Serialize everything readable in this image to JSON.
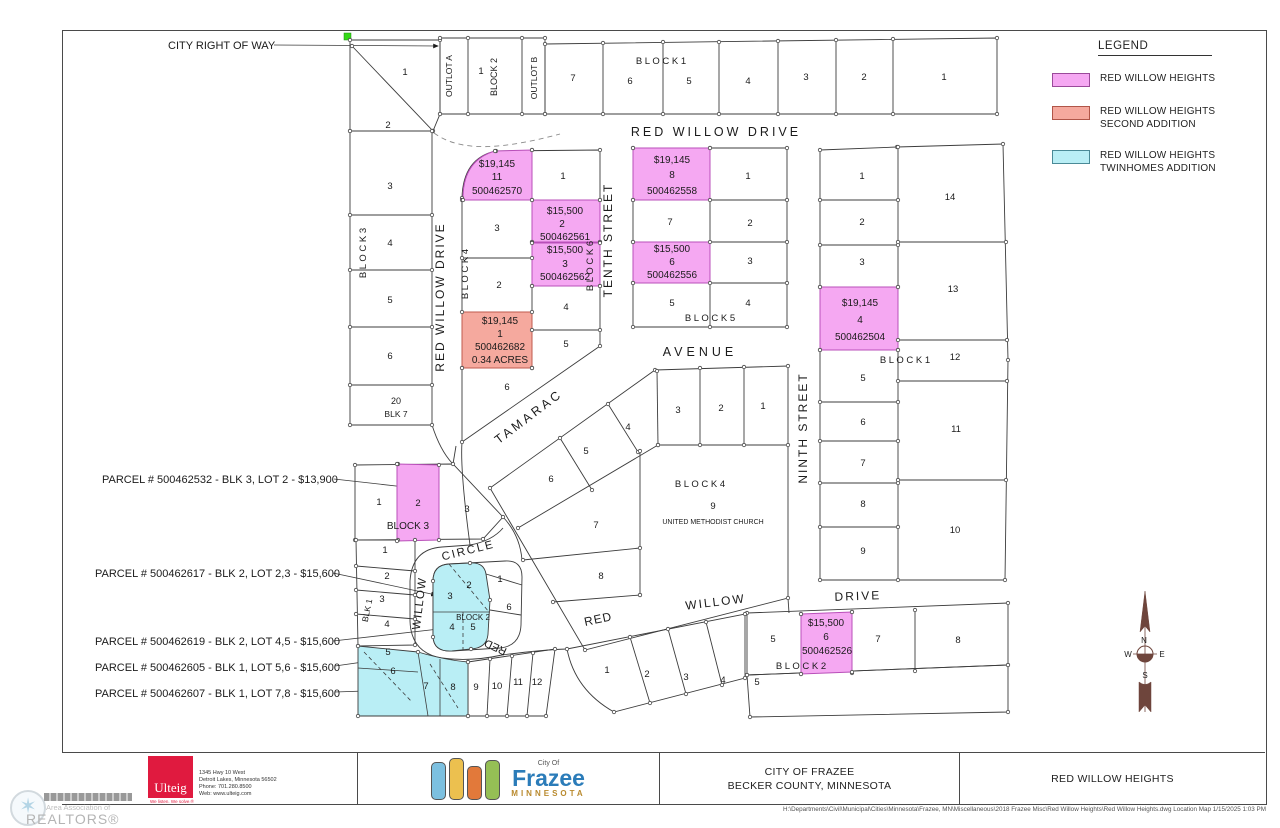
{
  "legend": {
    "title": "LEGEND",
    "items": [
      {
        "color": "#f5a8f2",
        "lines": [
          "RED WILLOW HEIGHTS"
        ]
      },
      {
        "color": "#f5a99e",
        "lines": [
          "RED WILLOW HEIGHTS",
          "SECOND ADDITION"
        ]
      },
      {
        "color": "#b9eef5",
        "lines": [
          "RED WILLOW HEIGHTS",
          "TWINHOMES ADDITION"
        ]
      }
    ]
  },
  "title_block": {
    "ulteig": {
      "name": "Ulteig",
      "tagline": "We listen. We solve.®",
      "address": [
        "1345 Hwy 10 West",
        "Detroit Lakes, Minnesota  56502",
        "Phone:  701.280.8500",
        "Web:  www.ulteig.com"
      ]
    },
    "city_logo": {
      "small": "City Of",
      "name": "Frazee",
      "state": "MINNESOTA"
    },
    "project_line1": "CITY OF FRAZEE",
    "project_line2": "BECKER COUNTY, MINNESOTA",
    "sheet_title": "RED WILLOW HEIGHTS"
  },
  "sheet": {
    "file_path": "H:\\Departments\\Civil\\Municipal\\Cities\\Minnesota\\Frazee, MN\\Miscellaneous\\2018 Frazee Misc\\Red Willow Heights\\Red Willow Heights.dwg Location Map 1/15/2025 1:03 PM"
  },
  "watermark": {
    "line1": "Area Association of",
    "line2": "REALTORS®"
  },
  "map": {
    "highlight_colors": {
      "red_willow_heights": "#f5a8f2",
      "second_addition": "#f5a99e",
      "twinhomes_addition": "#b9eef5"
    },
    "texts": [
      {
        "t": "CITY RIGHT OF WAY",
        "x": 168,
        "y": 49,
        "s": 11,
        "a": "start",
        "k": "callout-city-right-of-way"
      },
      {
        "t": "PARCEL # 500462532 - BLK 3, LOT 2 - $13,900",
        "x": 102,
        "y": 483,
        "s": 11,
        "a": "start",
        "k": "parcel-callout"
      },
      {
        "t": "PARCEL # 500462617 - BLK 2, LOT 2,3 - $15,600",
        "x": 95,
        "y": 577,
        "s": 11,
        "a": "start",
        "k": "parcel-callout"
      },
      {
        "t": "PARCEL # 500462619 - BLK 2, LOT 4,5 - $15,600",
        "x": 95,
        "y": 645,
        "s": 11,
        "a": "start",
        "k": "parcel-callout"
      },
      {
        "t": "PARCEL # 500462605 - BLK 1, LOT 5,6 - $15,600",
        "x": 95,
        "y": 671,
        "s": 11,
        "a": "start",
        "k": "parcel-callout"
      },
      {
        "t": "PARCEL # 500462607 - BLK 1, LOT 7,8 - $15,600",
        "x": 95,
        "y": 697,
        "s": 11,
        "a": "start",
        "k": "parcel-callout"
      },
      {
        "t": "RED WILLOW DRIVE",
        "x": 716,
        "y": 136,
        "s": 12.5,
        "ls": 3,
        "k": "street-label"
      },
      {
        "t": "RED WILLOW DRIVE",
        "x": 444,
        "y": 297,
        "r": -90,
        "s": 12,
        "ls": 2,
        "k": "street-label"
      },
      {
        "t": "TENTH STREET",
        "x": 612,
        "y": 240,
        "r": -90,
        "s": 12,
        "ls": 2,
        "k": "street-label"
      },
      {
        "t": "NINTH STREET",
        "x": 807,
        "y": 428,
        "r": -90,
        "s": 12,
        "ls": 2,
        "k": "street-label"
      },
      {
        "t": "TAMARAC",
        "x": 531,
        "y": 420,
        "r": -37,
        "s": 12.5,
        "ls": 3,
        "k": "street-label"
      },
      {
        "t": "AVENUE",
        "x": 700,
        "y": 356,
        "s": 12.5,
        "ls": 4,
        "k": "street-label"
      },
      {
        "t": "WILLOW",
        "x": 423,
        "y": 604,
        "r": -83,
        "s": 11.5,
        "ls": 1,
        "k": "street-label"
      },
      {
        "t": "CIRCLE",
        "x": 469,
        "y": 554,
        "r": -14,
        "s": 11.5,
        "ls": 2,
        "k": "street-label"
      },
      {
        "t": "RED",
        "x": 497,
        "y": 644,
        "r": -155,
        "s": 11,
        "k": "street-label"
      },
      {
        "t": "RED",
        "x": 599,
        "y": 623,
        "r": -12,
        "s": 12,
        "ls": 1,
        "k": "street-label"
      },
      {
        "t": "WILLOW",
        "x": 716,
        "y": 606,
        "r": -7,
        "s": 12,
        "ls": 2,
        "k": "street-label"
      },
      {
        "t": "DRIVE",
        "x": 858,
        "y": 600,
        "r": -2,
        "s": 12,
        "ls": 2,
        "k": "street-label"
      },
      {
        "t": "B L O C K  1",
        "x": 661,
        "y": 64,
        "k": "block-label"
      },
      {
        "t": "BLOCK 2",
        "x": 497,
        "y": 77,
        "r": -90,
        "s": 9,
        "k": "block-label"
      },
      {
        "t": "B L O C K  3",
        "x": 366,
        "y": 253,
        "r": -90,
        "k": "block-label"
      },
      {
        "t": "B L O C K  4",
        "x": 468,
        "y": 274,
        "r": -90,
        "k": "block-label"
      },
      {
        "t": "B L O C K  6",
        "x": 593,
        "y": 266,
        "r": -90,
        "k": "block-label"
      },
      {
        "t": "B L O C K  5",
        "x": 710,
        "y": 321,
        "k": "block-label"
      },
      {
        "t": "B L O C K  4",
        "x": 700,
        "y": 487,
        "k": "block-label"
      },
      {
        "t": "B L O C K  1",
        "x": 905,
        "y": 363,
        "k": "block-label"
      },
      {
        "t": "BLOCK  3",
        "x": 408,
        "y": 529,
        "s": 10,
        "k": "block-label"
      },
      {
        "t": "BLOCK 2",
        "x": 473,
        "y": 620,
        "s": 8,
        "k": "block-label"
      },
      {
        "t": "B L O C K  2",
        "x": 801,
        "y": 669,
        "k": "block-label"
      },
      {
        "t": "BLK 1",
        "x": 370,
        "y": 611,
        "r": -78,
        "s": 8.5,
        "k": "block-label"
      },
      {
        "t": "20",
        "x": 396,
        "y": 404,
        "s": 9,
        "k": "lot-number"
      },
      {
        "t": "BLK 7",
        "x": 396,
        "y": 417,
        "s": 8.5,
        "k": "block-label"
      },
      {
        "t": "OUTLOT A",
        "x": 452,
        "y": 76,
        "r": -90,
        "s": 8.5,
        "k": "outlot-label"
      },
      {
        "t": "OUTLOT B",
        "x": 537,
        "y": 78,
        "r": -90,
        "s": 8.5,
        "k": "outlot-label"
      },
      {
        "t": "UNITED METHODIST CHURCH",
        "x": 713,
        "y": 524,
        "s": 7,
        "k": "owner-label"
      },
      {
        "t": "7",
        "x": 573,
        "y": 81,
        "k": "lot-number"
      },
      {
        "t": "6",
        "x": 630,
        "y": 84,
        "k": "lot-number"
      },
      {
        "t": "5",
        "x": 689,
        "y": 84,
        "k": "lot-number"
      },
      {
        "t": "4",
        "x": 748,
        "y": 84,
        "k": "lot-number"
      },
      {
        "t": "3",
        "x": 806,
        "y": 80,
        "k": "lot-number"
      },
      {
        "t": "2",
        "x": 864,
        "y": 80,
        "k": "lot-number"
      },
      {
        "t": "1",
        "x": 944,
        "y": 80,
        "k": "lot-number"
      },
      {
        "t": "1",
        "x": 481,
        "y": 74,
        "k": "lot-number"
      },
      {
        "t": "1",
        "x": 405,
        "y": 75,
        "k": "lot-number"
      },
      {
        "t": "2",
        "x": 388,
        "y": 128,
        "k": "lot-number"
      },
      {
        "t": "3",
        "x": 390,
        "y": 189,
        "k": "lot-number"
      },
      {
        "t": "4",
        "x": 390,
        "y": 246,
        "k": "lot-number"
      },
      {
        "t": "5",
        "x": 390,
        "y": 303,
        "k": "lot-number"
      },
      {
        "t": "6",
        "x": 390,
        "y": 359,
        "k": "lot-number"
      },
      {
        "t": "1",
        "x": 563,
        "y": 179,
        "k": "lot-number"
      },
      {
        "t": "3",
        "x": 497,
        "y": 231,
        "k": "lot-number"
      },
      {
        "t": "2",
        "x": 499,
        "y": 288,
        "k": "lot-number"
      },
      {
        "t": "4",
        "x": 566,
        "y": 310,
        "k": "lot-number"
      },
      {
        "t": "5",
        "x": 566,
        "y": 347,
        "k": "lot-number"
      },
      {
        "t": "6",
        "x": 507,
        "y": 390,
        "k": "lot-number"
      },
      {
        "t": "1",
        "x": 748,
        "y": 179,
        "k": "lot-number"
      },
      {
        "t": "7",
        "x": 670,
        "y": 225,
        "k": "lot-number"
      },
      {
        "t": "2",
        "x": 750,
        "y": 226,
        "k": "lot-number"
      },
      {
        "t": "3",
        "x": 750,
        "y": 264,
        "k": "lot-number"
      },
      {
        "t": "5",
        "x": 672,
        "y": 306,
        "k": "lot-number"
      },
      {
        "t": "4",
        "x": 748,
        "y": 306,
        "k": "lot-number"
      },
      {
        "t": "1",
        "x": 862,
        "y": 179,
        "k": "lot-number"
      },
      {
        "t": "2",
        "x": 862,
        "y": 225,
        "k": "lot-number"
      },
      {
        "t": "3",
        "x": 862,
        "y": 265,
        "k": "lot-number"
      },
      {
        "t": "14",
        "x": 950,
        "y": 200,
        "k": "lot-number"
      },
      {
        "t": "13",
        "x": 953,
        "y": 292,
        "k": "lot-number"
      },
      {
        "t": "12",
        "x": 955,
        "y": 360,
        "k": "lot-number"
      },
      {
        "t": "5",
        "x": 863,
        "y": 381,
        "k": "lot-number"
      },
      {
        "t": "6",
        "x": 863,
        "y": 425,
        "k": "lot-number"
      },
      {
        "t": "7",
        "x": 863,
        "y": 466,
        "k": "lot-number"
      },
      {
        "t": "8",
        "x": 863,
        "y": 507,
        "k": "lot-number"
      },
      {
        "t": "9",
        "x": 863,
        "y": 554,
        "k": "lot-number"
      },
      {
        "t": "11",
        "x": 956,
        "y": 432,
        "k": "lot-number"
      },
      {
        "t": "10",
        "x": 955,
        "y": 533,
        "k": "lot-number"
      },
      {
        "t": "3",
        "x": 678,
        "y": 413,
        "k": "lot-number"
      },
      {
        "t": "2",
        "x": 721,
        "y": 411,
        "k": "lot-number"
      },
      {
        "t": "1",
        "x": 763,
        "y": 409,
        "k": "lot-number"
      },
      {
        "t": "4",
        "x": 628,
        "y": 430,
        "k": "lot-number"
      },
      {
        "t": "5",
        "x": 586,
        "y": 454,
        "k": "lot-number"
      },
      {
        "t": "6",
        "x": 551,
        "y": 482,
        "k": "lot-number"
      },
      {
        "t": "7",
        "x": 596,
        "y": 528,
        "k": "lot-number"
      },
      {
        "t": "8",
        "x": 601,
        "y": 579,
        "k": "lot-number"
      },
      {
        "t": "9",
        "x": 713,
        "y": 509,
        "k": "lot-number"
      },
      {
        "t": "1",
        "x": 379,
        "y": 505,
        "k": "lot-number"
      },
      {
        "t": "2",
        "x": 418,
        "y": 506,
        "k": "lot-number"
      },
      {
        "t": "3",
        "x": 467,
        "y": 512,
        "k": "lot-number"
      },
      {
        "t": "1",
        "x": 385,
        "y": 553,
        "k": "lot-number"
      },
      {
        "t": "2",
        "x": 387,
        "y": 579,
        "k": "lot-number"
      },
      {
        "t": "3",
        "x": 382,
        "y": 602,
        "k": "lot-number"
      },
      {
        "t": "4",
        "x": 387,
        "y": 627,
        "k": "lot-number"
      },
      {
        "t": "5",
        "x": 388,
        "y": 655,
        "k": "lot-number"
      },
      {
        "t": "6",
        "x": 393,
        "y": 674,
        "k": "lot-number"
      },
      {
        "t": "7",
        "x": 426,
        "y": 689,
        "k": "lot-number"
      },
      {
        "t": "8",
        "x": 453,
        "y": 690,
        "k": "lot-number"
      },
      {
        "t": "9",
        "x": 476,
        "y": 690,
        "k": "lot-number"
      },
      {
        "t": "10",
        "x": 497,
        "y": 689,
        "k": "lot-number"
      },
      {
        "t": "11",
        "x": 518,
        "y": 685,
        "k": "lot-number"
      },
      {
        "t": "12",
        "x": 537,
        "y": 685,
        "k": "lot-number"
      },
      {
        "t": "2",
        "x": 469,
        "y": 588,
        "k": "lot-number"
      },
      {
        "t": "3",
        "x": 450,
        "y": 599,
        "k": "lot-number"
      },
      {
        "t": "4",
        "x": 452,
        "y": 630,
        "k": "lot-number"
      },
      {
        "t": "5",
        "x": 473,
        "y": 630,
        "k": "lot-number"
      },
      {
        "t": "1",
        "x": 500,
        "y": 582,
        "k": "lot-number"
      },
      {
        "t": "6",
        "x": 509,
        "y": 610,
        "k": "lot-number"
      },
      {
        "t": "1",
        "x": 607,
        "y": 673,
        "k": "lot-number"
      },
      {
        "t": "2",
        "x": 647,
        "y": 677,
        "k": "lot-number"
      },
      {
        "t": "3",
        "x": 686,
        "y": 680,
        "k": "lot-number"
      },
      {
        "t": "4",
        "x": 723,
        "y": 683,
        "k": "lot-number"
      },
      {
        "t": "5",
        "x": 757,
        "y": 685,
        "k": "lot-number"
      },
      {
        "t": "5",
        "x": 773,
        "y": 642,
        "k": "lot-number"
      },
      {
        "t": "7",
        "x": 878,
        "y": 642,
        "k": "lot-number"
      },
      {
        "t": "8",
        "x": 958,
        "y": 643,
        "k": "lot-number"
      },
      {
        "t": "$19,145",
        "x": 497,
        "y": 167,
        "s": 10,
        "k": "parcel-price"
      },
      {
        "t": "11",
        "x": 497,
        "y": 180,
        "s": 10,
        "k": "parcel-lot"
      },
      {
        "t": "500462570",
        "x": 497,
        "y": 194,
        "s": 10,
        "k": "parcel-id"
      },
      {
        "t": "$15,500",
        "x": 565,
        "y": 214,
        "s": 10,
        "k": "parcel-price"
      },
      {
        "t": "2",
        "x": 562,
        "y": 227,
        "s": 10,
        "k": "parcel-lot"
      },
      {
        "t": "500462561",
        "x": 565,
        "y": 240,
        "s": 10,
        "k": "parcel-id"
      },
      {
        "t": "$15,500",
        "x": 565,
        "y": 253,
        "s": 10,
        "k": "parcel-price"
      },
      {
        "t": "3",
        "x": 565,
        "y": 267,
        "s": 10,
        "k": "parcel-lot"
      },
      {
        "t": "500462562",
        "x": 565,
        "y": 280,
        "s": 10,
        "k": "parcel-id"
      },
      {
        "t": "$19,145",
        "x": 500,
        "y": 324,
        "s": 10,
        "k": "parcel-price"
      },
      {
        "t": "1",
        "x": 500,
        "y": 337,
        "s": 10,
        "k": "parcel-lot"
      },
      {
        "t": "500462682",
        "x": 500,
        "y": 350,
        "s": 10,
        "k": "parcel-id"
      },
      {
        "t": "0.34  ACRES",
        "x": 500,
        "y": 363,
        "s": 10,
        "k": "parcel-area"
      },
      {
        "t": "$19,145",
        "x": 672,
        "y": 163,
        "s": 10,
        "k": "parcel-price"
      },
      {
        "t": "8",
        "x": 672,
        "y": 178,
        "s": 10,
        "k": "parcel-lot"
      },
      {
        "t": "500462558",
        "x": 672,
        "y": 194,
        "s": 10,
        "k": "parcel-id"
      },
      {
        "t": "$15,500",
        "x": 672,
        "y": 252,
        "s": 10,
        "k": "parcel-price"
      },
      {
        "t": "6",
        "x": 672,
        "y": 265,
        "s": 10,
        "k": "parcel-lot"
      },
      {
        "t": "500462556",
        "x": 672,
        "y": 278,
        "s": 10,
        "k": "parcel-id"
      },
      {
        "t": "$19,145",
        "x": 860,
        "y": 306,
        "s": 10,
        "k": "parcel-price"
      },
      {
        "t": "4",
        "x": 860,
        "y": 323,
        "s": 10,
        "k": "parcel-lot"
      },
      {
        "t": "500462504",
        "x": 860,
        "y": 340,
        "s": 10,
        "k": "parcel-id"
      },
      {
        "t": "$15,500",
        "x": 826,
        "y": 626,
        "s": 10,
        "k": "parcel-price"
      },
      {
        "t": "6",
        "x": 826,
        "y": 640,
        "s": 10,
        "k": "parcel-lot"
      },
      {
        "t": "500462526",
        "x": 827,
        "y": 654,
        "s": 10,
        "k": "parcel-id"
      },
      {
        "t": "N",
        "x": 1144,
        "y": 643,
        "s": 8,
        "k": "compass-n"
      },
      {
        "t": "W",
        "x": 1128,
        "y": 657,
        "s": 8,
        "k": "compass-w"
      },
      {
        "t": "E",
        "x": 1162,
        "y": 657,
        "s": 8,
        "k": "compass-e"
      },
      {
        "t": "S",
        "x": 1145,
        "y": 678,
        "s": 8,
        "k": "compass-s"
      }
    ]
  }
}
